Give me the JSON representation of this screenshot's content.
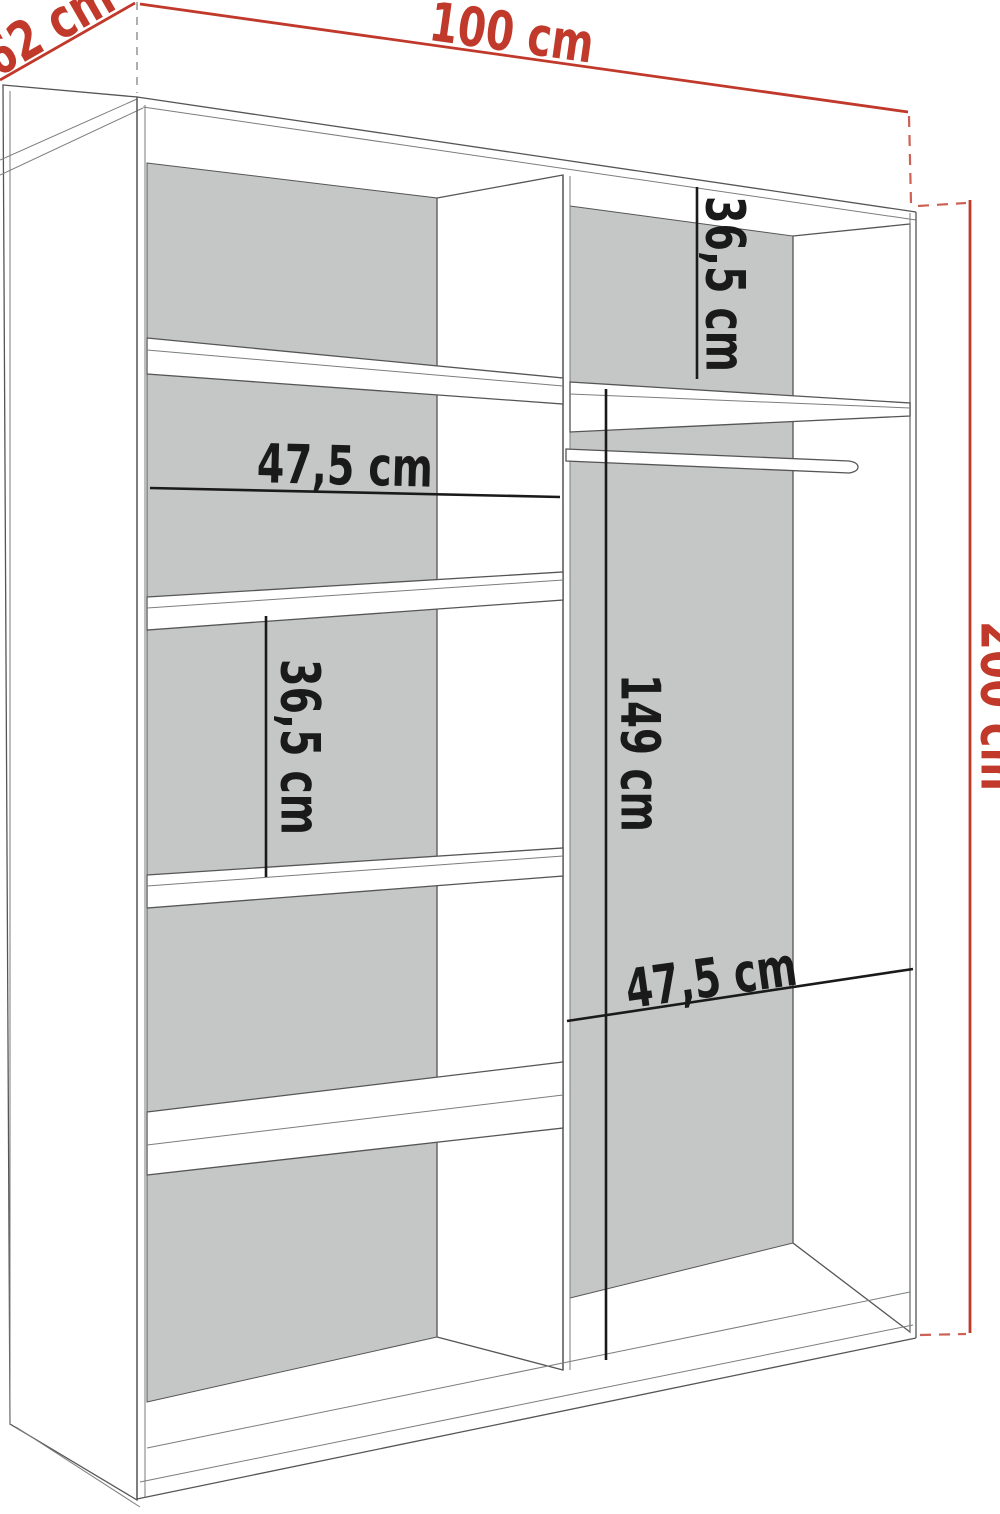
{
  "colors": {
    "dimension_red": "#c0392b",
    "dimension_black": "#1a1a1a",
    "panel_gray": "#c5c7c6",
    "outline": "#555555",
    "background": "#ffffff"
  },
  "dimensions": {
    "overall_width": "100 cm",
    "overall_depth": "62 cm",
    "overall_height": "200 cm",
    "right_top_section_height": "36,5 cm",
    "left_section_width": "47,5 cm",
    "left_middle_section_height": "36,5 cm",
    "hanging_space_height": "149 cm",
    "right_section_width": "47,5 cm"
  }
}
